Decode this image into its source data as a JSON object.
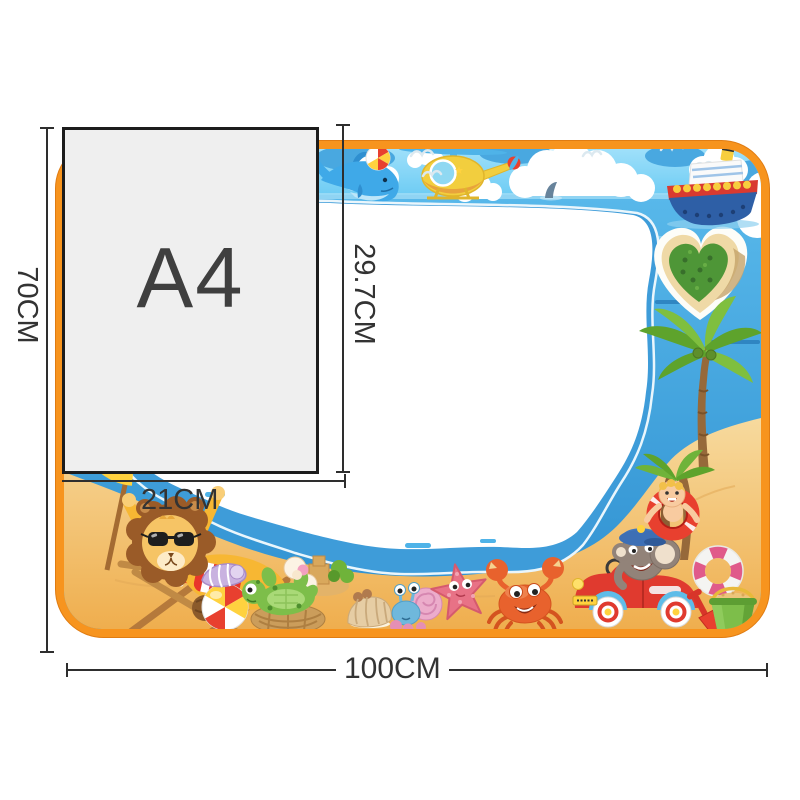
{
  "page": {
    "background": "#FFFFFF",
    "type": "product dimension illustration of kids water drawing mat"
  },
  "labels": {
    "mat_height": "70CM",
    "mat_width": "100CM",
    "paper_name": "A4",
    "paper_height": "29.7CM",
    "paper_width": "21CM"
  },
  "colors": {
    "mat_border": "#F7941E",
    "sky": "#6FC8F0",
    "sea": "#3F9FDC",
    "sand": "#F2CC86",
    "drawing_area": "#FFFFFF",
    "paper_fill": "#EFEFEF",
    "paper_border": "#1C1C1C",
    "dimension_line": "#2E2E2E"
  },
  "scene": {
    "mat": "beach-themed aqua doodle drawing mat with white drawing area",
    "elements": [
      "dolphin",
      "beach-ball",
      "helicopter",
      "seagulls",
      "clouds",
      "cruise-ship",
      "shark-fin",
      "heart-island",
      "palm-tree",
      "beach-umbrella",
      "lion-on-beach-chair",
      "spiral-shell",
      "turtle",
      "clam-shell",
      "hermit-crab",
      "starfish",
      "crab",
      "elephant-driving-car",
      "boy-in-swim-ring",
      "lifebuoy",
      "sand-bucket",
      "shovel",
      "sandcastle"
    ]
  }
}
